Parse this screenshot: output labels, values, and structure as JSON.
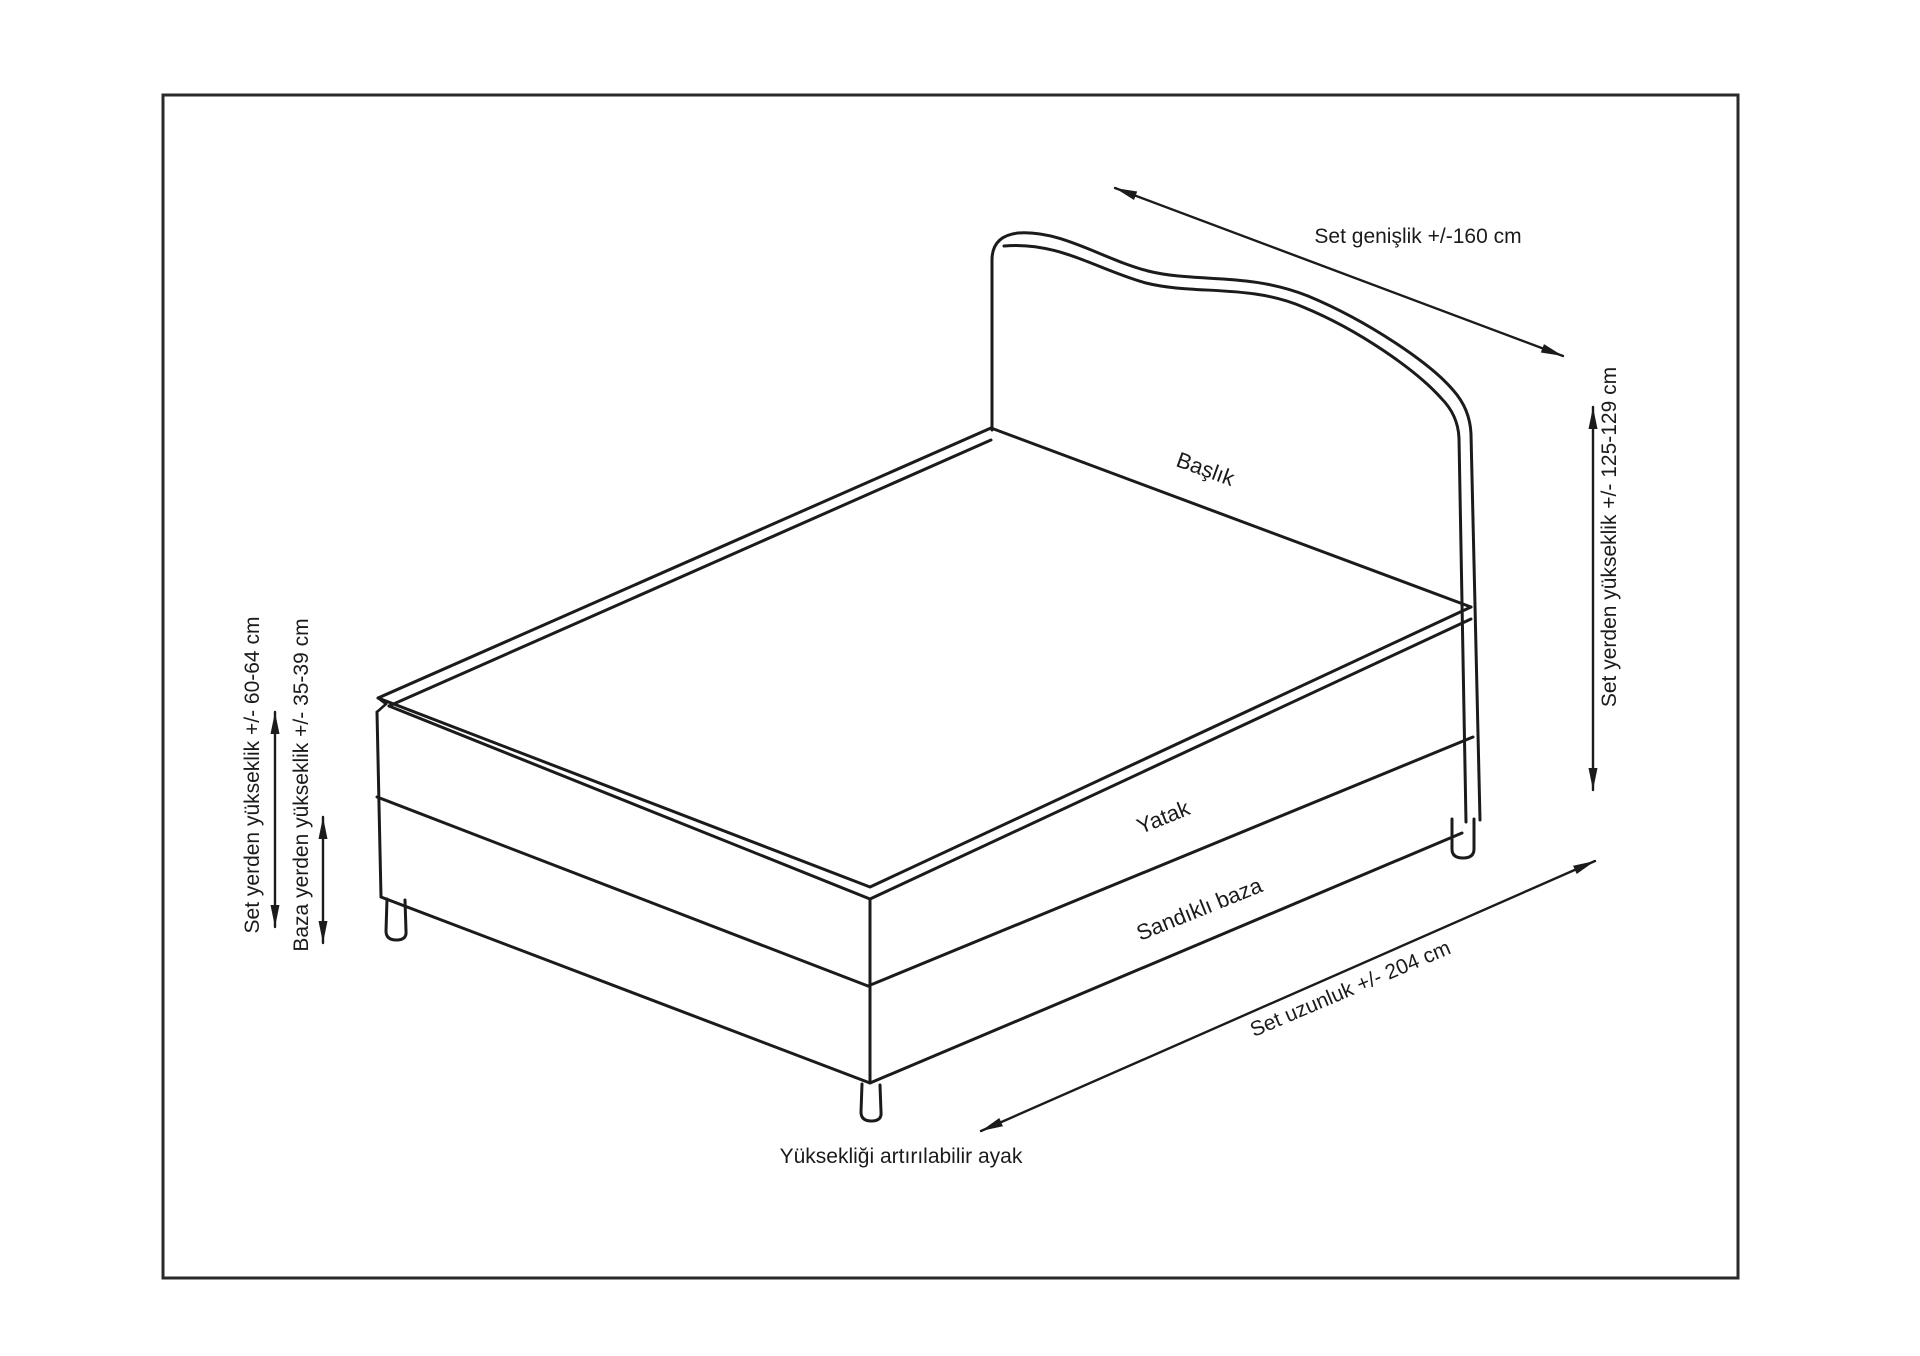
{
  "diagram": {
    "title": "Bed set dimension diagram",
    "labels": {
      "baslik": "Başlık",
      "yatak": "Yatak",
      "sandikli_baza": "Sandıklı baza",
      "ayak": "Yüksekliği artırılabilir ayak"
    },
    "dimensions": {
      "genislik": "Set genişlik +/-160 cm",
      "yukseklik_sag": "Set yerden yükseklik +/- 125-129 cm",
      "yukseklik_sol": "Set yerden yükseklik +/- 60-64 cm",
      "baza_yukseklik": "Baza yerden yükseklik +/- 35-39 cm",
      "uzunluk": "Set uzunluk +/- 204 cm"
    },
    "colors": {
      "line": "#1b1b1b",
      "background": "#ffffff"
    }
  }
}
